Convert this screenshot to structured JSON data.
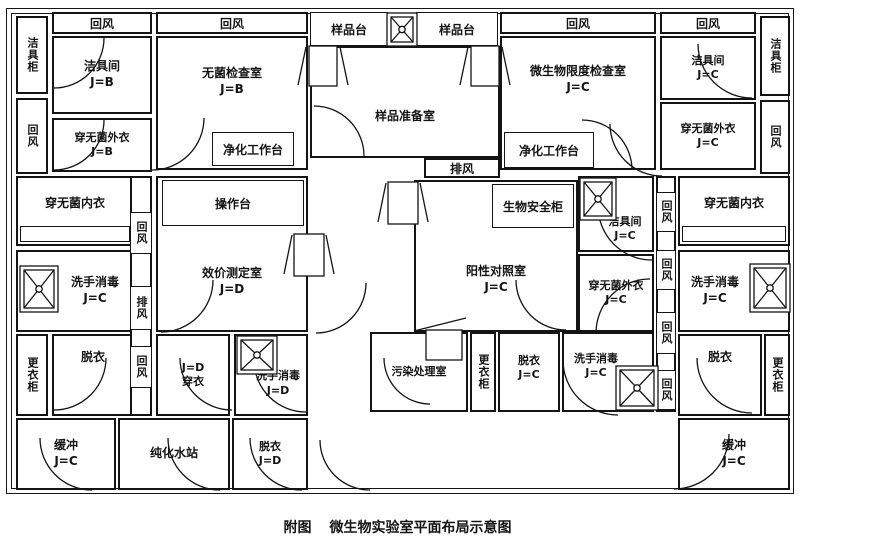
{
  "caption": {
    "prefix": "附图",
    "title": "微生物实验室平面布局示意图"
  },
  "labels": {
    "return_air": "回风",
    "exhaust_air": "排风"
  },
  "cabinets": {
    "cleaning_cabinet": "洁具柜",
    "clothes_cabinet": "更衣柜"
  },
  "equipment": {
    "clean_bench": "净化工作台",
    "operation_bench": "操作台",
    "biosafety_cabinet": "生物安全柜",
    "sample_bench": "样品台"
  },
  "rooms": {
    "cleaning_room_b": {
      "name": "洁具间",
      "grade": "J=B"
    },
    "sterile_inspection_room": {
      "name": "无菌检查室",
      "grade": "J=B"
    },
    "sterile_outerwear_b": {
      "name": "穿无菌外衣",
      "grade": "J=B"
    },
    "sterile_innerwear_left": {
      "name": "穿无菌内衣"
    },
    "handwash_left": {
      "name": "洗手消毒",
      "grade": "J=C"
    },
    "undress_left": {
      "name": "脱衣"
    },
    "buffer_left": {
      "name": "缓冲",
      "grade": "J=C"
    },
    "purified_water_station": {
      "name": "纯化水站"
    },
    "dress_d": {
      "name": "穿衣",
      "grade": "J=D"
    },
    "handwash_d": {
      "name": "洗手消毒",
      "grade": "J=D"
    },
    "undress_d": {
      "name": "脱衣",
      "grade": "J=D"
    },
    "potency_test_room": {
      "name": "效价测定室",
      "grade": "J=D"
    },
    "sample_prep_room": {
      "name": "样品准备室"
    },
    "positive_control_room": {
      "name": "阳性对照室",
      "grade": "J=C"
    },
    "contamination_treatment_room": {
      "name": "污染处理室"
    },
    "undress_center": {
      "name": "脱衣",
      "grade": "J=C"
    },
    "handwash_center": {
      "name": "洗手消毒",
      "grade": "J=C"
    },
    "cleaning_room_center": {
      "name": "洁具间",
      "grade": "J=C"
    },
    "sterile_outerwear_center": {
      "name": "穿无菌外衣",
      "grade": "J=C"
    },
    "micro_limit_test_room": {
      "name": "微生物限度检查室",
      "grade": "J=C"
    },
    "cleaning_room_right": {
      "name": "洁具间",
      "grade": "J=C"
    },
    "sterile_outerwear_right": {
      "name": "穿无菌外衣",
      "grade": "J=C"
    },
    "sterile_innerwear_right": {
      "name": "穿无菌内衣"
    },
    "handwash_right": {
      "name": "洗手消毒",
      "grade": "J=C"
    },
    "undress_right": {
      "name": "脱衣"
    },
    "buffer_right": {
      "name": "缓冲",
      "grade": "J=C"
    }
  }
}
